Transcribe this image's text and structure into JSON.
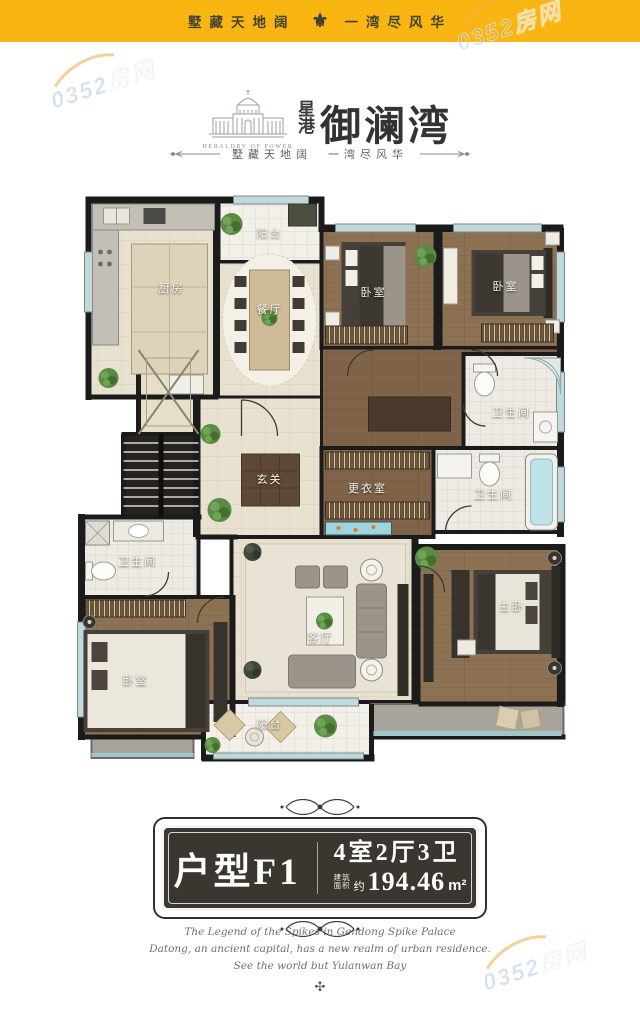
{
  "banner": {
    "left": "墅藏天地阔",
    "right": "一湾尽风华",
    "ornament": "⚜"
  },
  "watermark": {
    "text": "0352房网"
  },
  "logo": {
    "english": "HERALDRY OF POWER",
    "seal_top": "星",
    "seal_bottom": "港",
    "brand": "御澜湾",
    "tagline": "墅藏天地阔　一湾尽风华"
  },
  "plan": {
    "rooms": [
      {
        "label": "阳台"
      },
      {
        "label": "厨房"
      },
      {
        "label": "餐厅"
      },
      {
        "label": "卧室"
      },
      {
        "label": "卧室"
      },
      {
        "label": "卫生间"
      },
      {
        "label": "玄关"
      },
      {
        "label": "更衣室"
      },
      {
        "label": "卫生间"
      },
      {
        "label": "卫生间"
      },
      {
        "label": "卧室"
      },
      {
        "label": "客厅"
      },
      {
        "label": "主卧"
      },
      {
        "label": "阳台"
      }
    ]
  },
  "badge": {
    "type_name": "户型F1",
    "spec": "4室2厅3卫",
    "area_label_1": "建筑",
    "area_label_2": "面积",
    "approx": "约",
    "area_value": "194.46",
    "area_unit": "m²"
  },
  "footer": {
    "line1": "The Legend of the Spikes in Gendong Spike Palace",
    "line2": "Datong, an ancient capital, has a new realm of urban residence.",
    "line3": "See the world but Yulanwan Bay",
    "ornament": "✣"
  },
  "colors": {
    "banner_yellow": "#F9B612",
    "plaque_dark": "#3B362F",
    "wall_black": "#1B1B1B",
    "wood_floor": "#8C7152",
    "tile_beige": "#E8E1D0",
    "window_blue": "#C3D8DA"
  }
}
